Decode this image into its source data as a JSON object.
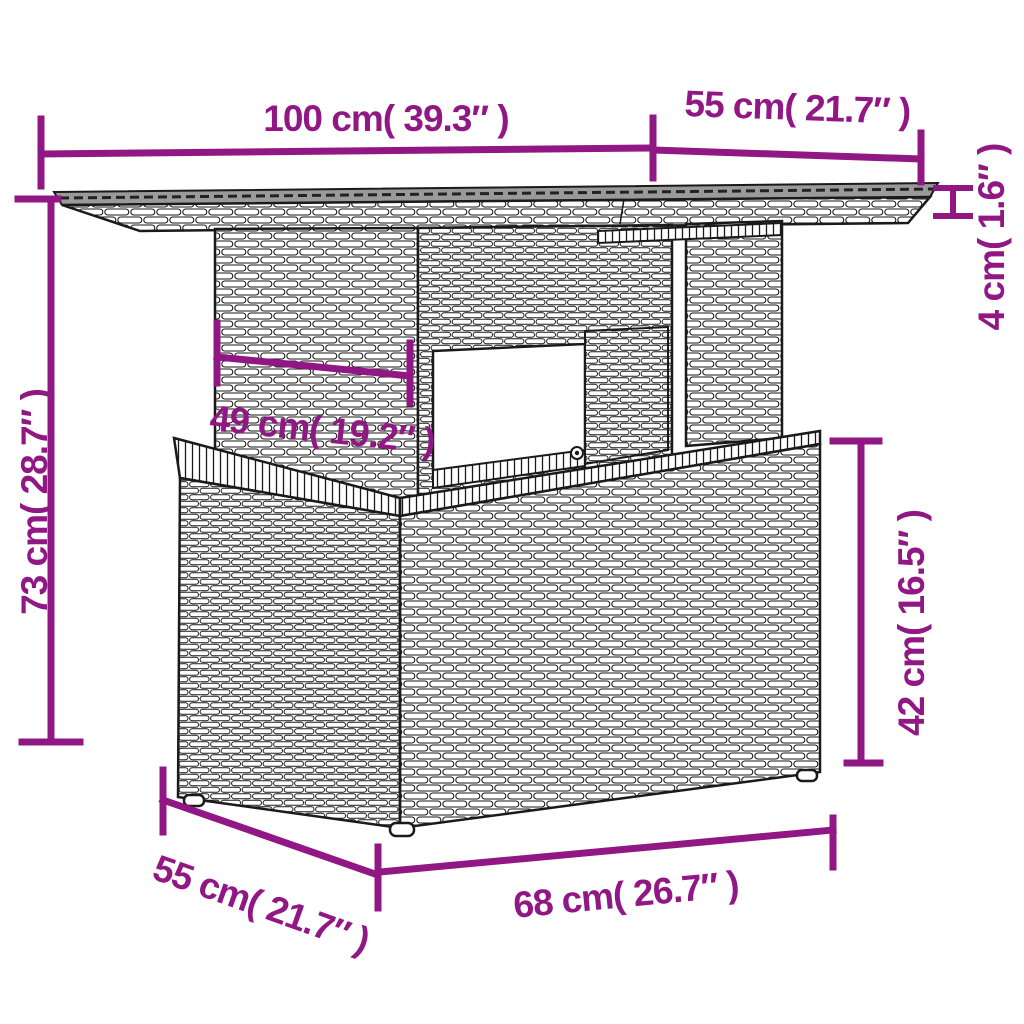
{
  "figure_type": "furniture-dimension-diagram",
  "colors": {
    "dimension_line": "#911884",
    "line_art": "#1a1a1a",
    "tabletop_surface": "#9a9a9a",
    "background": "#ffffff"
  },
  "dimensions": {
    "tabletop_length": {
      "cm": 100,
      "inches": 39.3,
      "label": "100 cm( 39.3″ )"
    },
    "tabletop_depth": {
      "cm": 55,
      "inches": 21.7,
      "label": "55 cm( 21.7″ )"
    },
    "tabletop_thickness": {
      "cm": 4,
      "inches": 1.6,
      "label": "4 cm( 1.6″ )"
    },
    "total_height": {
      "cm": 73,
      "inches": 28.7,
      "label": "73 cm( 28.7″ )"
    },
    "pedestal_width": {
      "cm": 49,
      "inches": 19.2,
      "label": "49 cm( 19.2″ )"
    },
    "base_height": {
      "cm": 42,
      "inches": 16.5,
      "label": "42 cm( 16.5″ )"
    },
    "base_depth": {
      "cm": 55,
      "inches": 21.7,
      "label": "55 cm( 21.7″ )"
    },
    "base_width": {
      "cm": 68,
      "inches": 26.7,
      "label": "68 cm( 26.7″ )"
    }
  }
}
